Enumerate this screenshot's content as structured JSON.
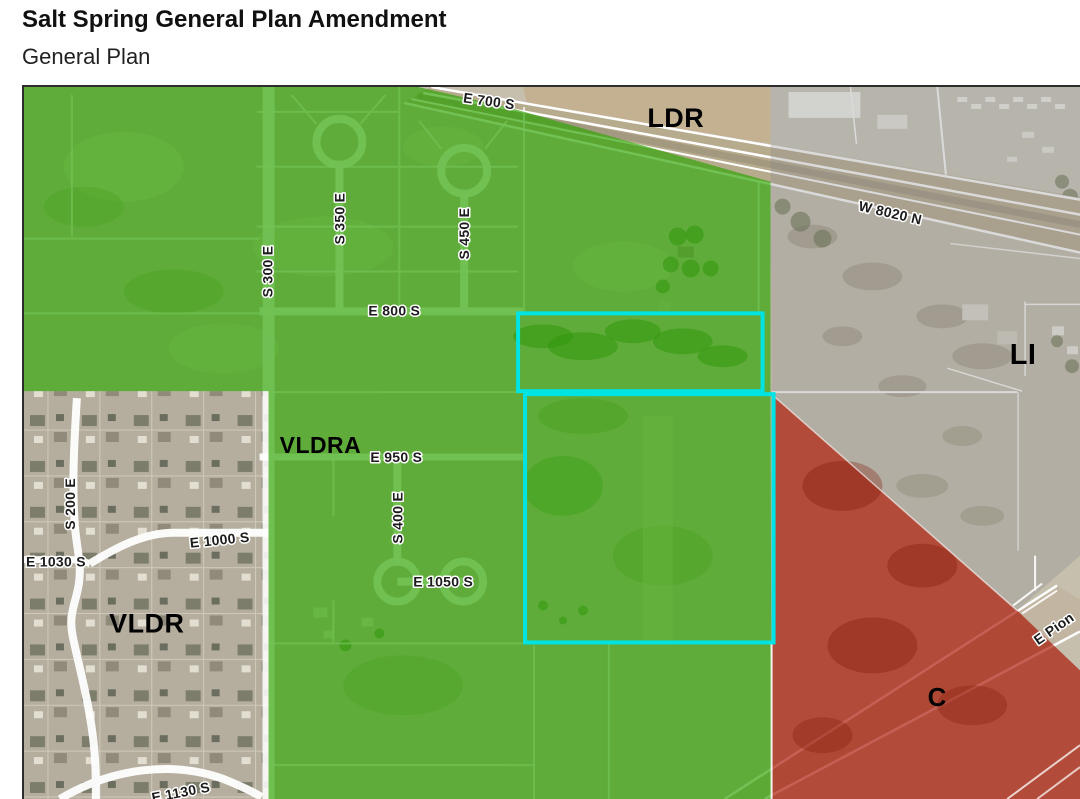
{
  "header": {
    "title": "Salt Spring General Plan Amendment",
    "subtitle": "General Plan"
  },
  "map": {
    "zone_labels": {
      "ldr": "LDR",
      "vldra": "VLDRA",
      "vldr": "VLDR",
      "li": "LI",
      "c": "C"
    },
    "street_labels": {
      "e700s": "E 700 S",
      "w8020n": "W 8020 N",
      "s300e": "S 300 E",
      "s350e": "S 350 E",
      "s450e": "S 450 E",
      "e800s": "E 800 S",
      "e950s": "E 950 S",
      "s400e": "S 400 E",
      "e1000s": "E 1000 S",
      "e1030s": "E 1030 S",
      "e1050s": "E 1050 S",
      "s200e": "S 200 E",
      "e1130s": "E 1130 S",
      "e_pioneer": "E Pion"
    },
    "colors": {
      "ldr_green": "#2ea303",
      "li_gray": "#8c8c8c",
      "c_red": "#a81503",
      "parcel_cyan": "#00e3e3"
    }
  }
}
